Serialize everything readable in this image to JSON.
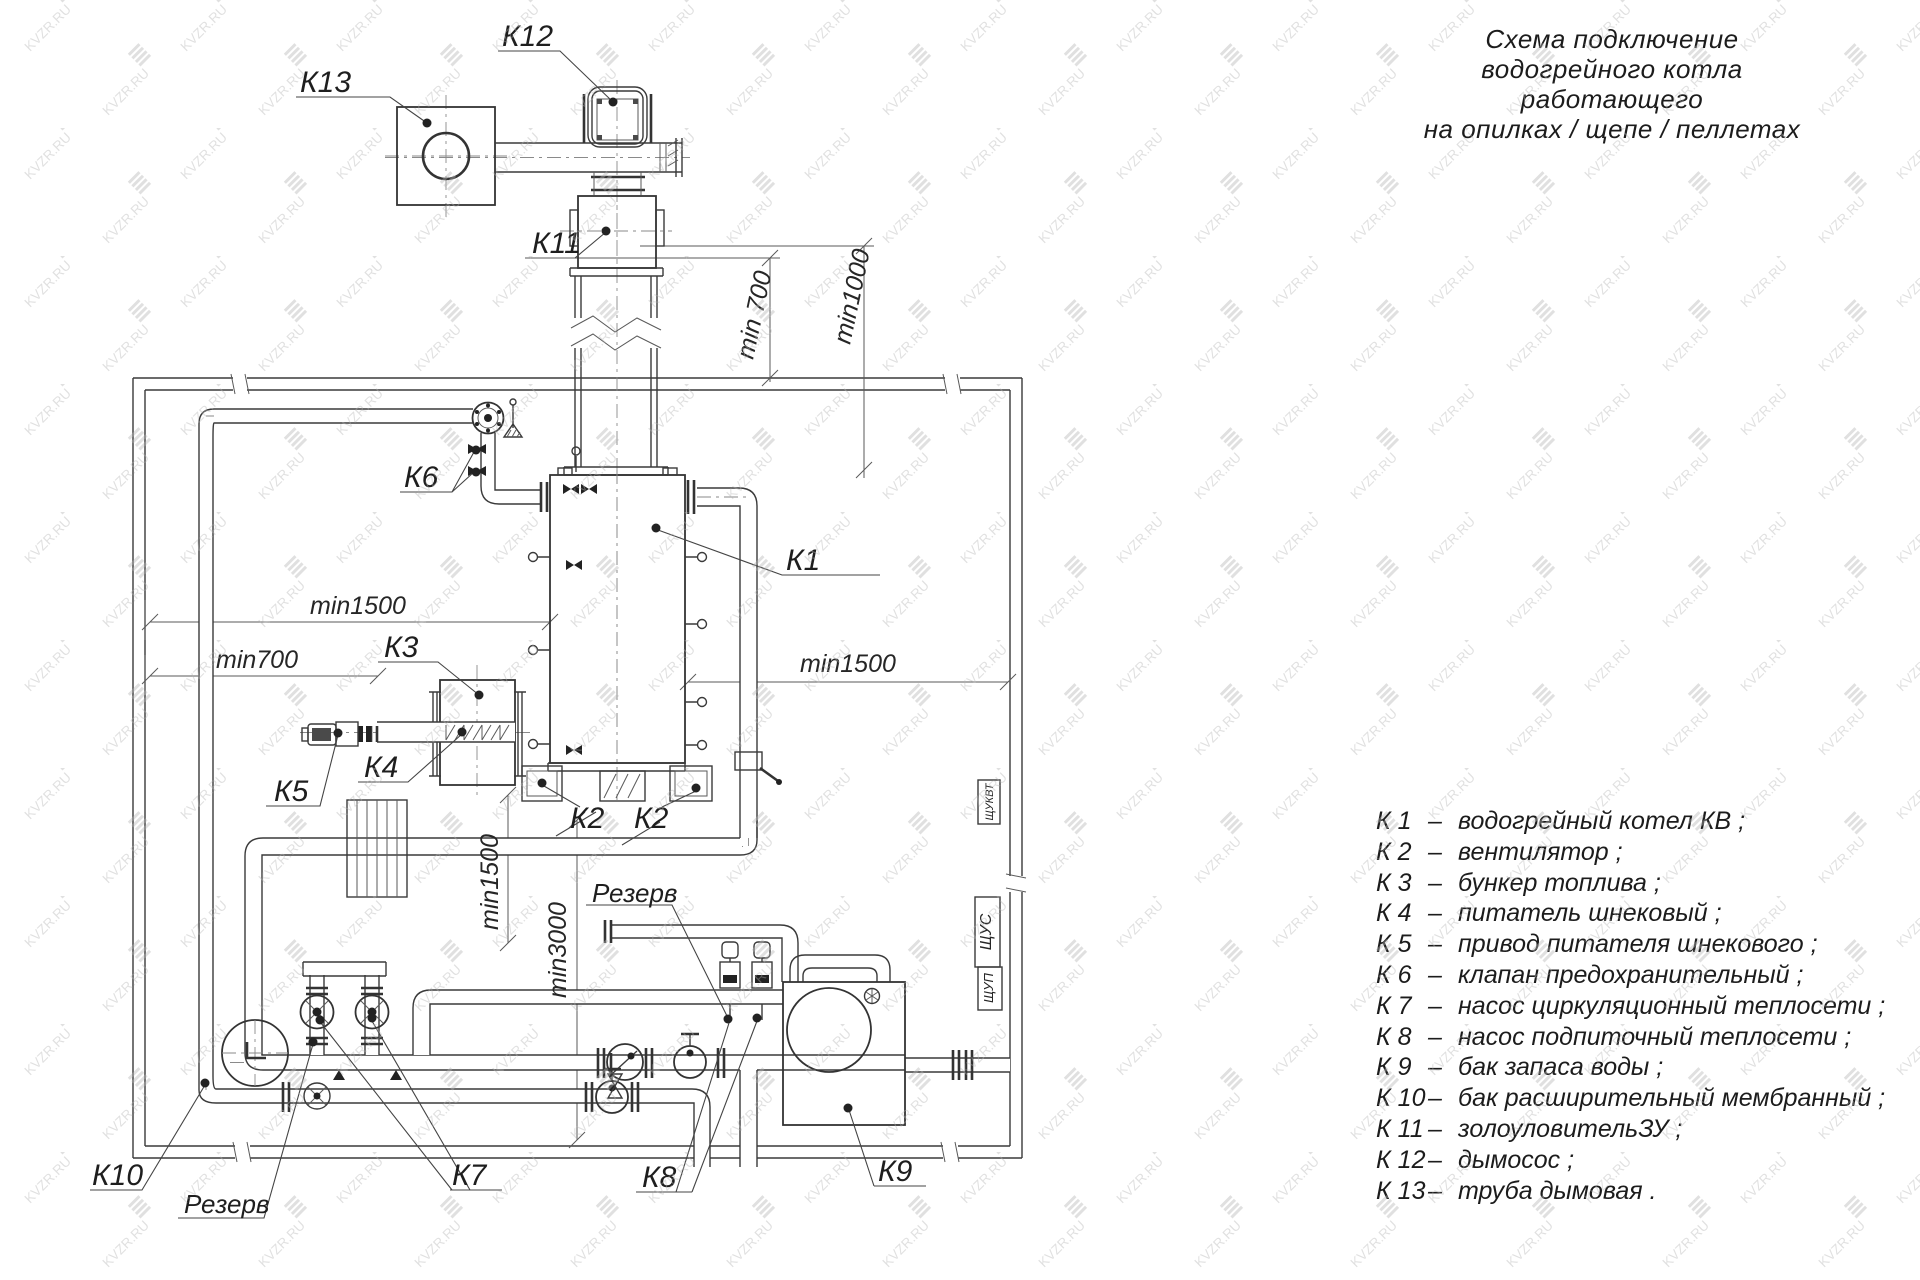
{
  "title": {
    "line1": "Схема подключение",
    "line2": "водогрейного котла работающего",
    "line3": "на опилках / щепе / пеллетах"
  },
  "watermark": {
    "text": "KVZR.RU"
  },
  "diagram": {
    "labels": {
      "k1": "К1",
      "k2": "К2",
      "k3": "К3",
      "k4": "К4",
      "k5": "К5",
      "k6": "К6",
      "k7": "К7",
      "k8": "К8",
      "k9": "К9",
      "k10": "К10",
      "k11": "К11",
      "k12": "К12",
      "k13": "К13",
      "reserve": "Резерв"
    },
    "dimensions": {
      "min700_top": "min 700",
      "min1000_top": "min1000",
      "min1500_left": "min1500",
      "min700_left": "min700",
      "min1500_right": "min1500",
      "min1500_vert": "min1500",
      "min3000_vert": "min3000"
    },
    "cabinets": {
      "c1": "ЩУКВТ",
      "c2": "ЩУС",
      "c3": "ЩУП"
    }
  },
  "legend": {
    "separator": "–",
    "items": [
      {
        "id": "К 1",
        "text": "водогрейный котел КВ ;"
      },
      {
        "id": "К 2",
        "text": "вентилятор ;"
      },
      {
        "id": "К 3",
        "text": "бункер топлива ;"
      },
      {
        "id": "К 4",
        "text": "питатель шнековый ;"
      },
      {
        "id": "К 5",
        "text": "привод питателя шнекового ;"
      },
      {
        "id": "К 6",
        "text": "клапан предохранительный ;"
      },
      {
        "id": "К 7",
        "text": "насос циркуляционный теплосети ;"
      },
      {
        "id": "К 8",
        "text": "насос подпиточный теплосети ;"
      },
      {
        "id": "К 9",
        "text": "бак запаса воды ;"
      },
      {
        "id": "К 10",
        "text": "бак расширительный мембранный ;"
      },
      {
        "id": "К 11",
        "text": "золоуловительЗУ ;"
      },
      {
        "id": "К 12",
        "text": "дымосос ;"
      },
      {
        "id": "К 13",
        "text": "труба дымовая ."
      }
    ]
  }
}
